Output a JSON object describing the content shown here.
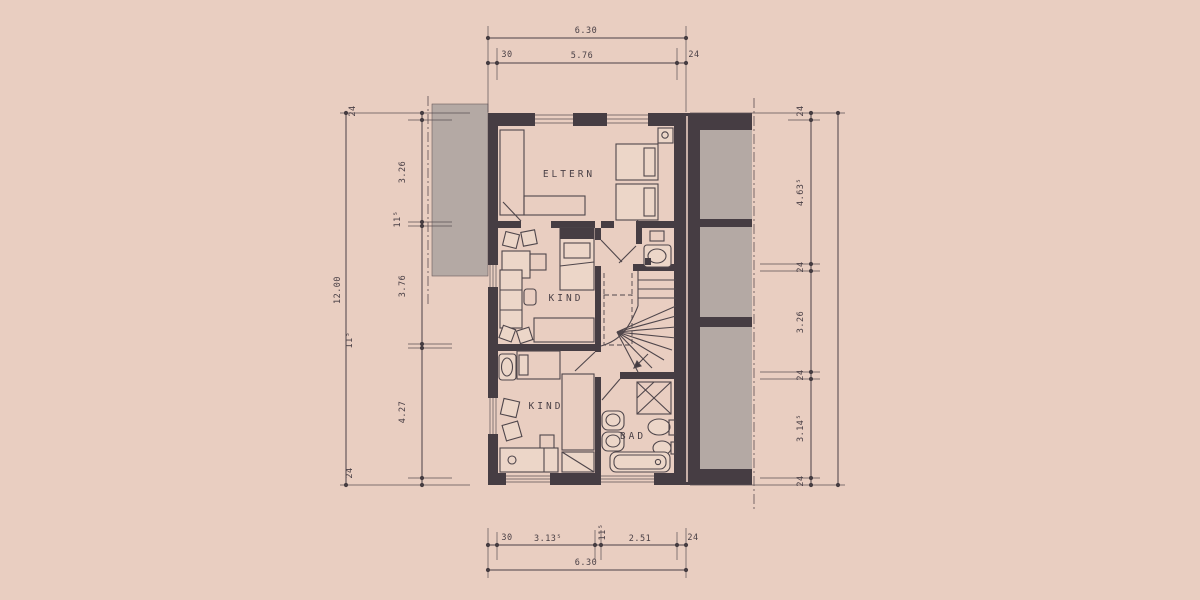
{
  "colors": {
    "paper": "#e9cec1",
    "ink": "#4a4046",
    "wall": "#463d43",
    "neighbor_gray": "#b4a9a4"
  },
  "rooms": {
    "parents": "ELTERN",
    "child1": "KIND",
    "child2": "KIND",
    "bath": "BAD"
  },
  "dims": {
    "top": {
      "overall": "6.30",
      "left_wall": "30",
      "inner": "5.76",
      "right_wall": "24"
    },
    "bottom": {
      "left_wall": "30",
      "left_room": "3.13⁵",
      "mid_wall": "11⁵",
      "right_room": "2.51",
      "right_wall": "24",
      "overall": "6.30"
    },
    "left": {
      "overall": "12.00",
      "c0": "24",
      "c1": "3.26",
      "c2": "11⁵",
      "c3": "3.76",
      "c4": "11⁵",
      "c5": "4.27",
      "c6": "24"
    },
    "right": {
      "c0": "24",
      "c1": "4.63⁵",
      "c2": "24",
      "c3": "3.26",
      "c4": "24",
      "c5": "3.14⁵",
      "c6": "24"
    }
  }
}
